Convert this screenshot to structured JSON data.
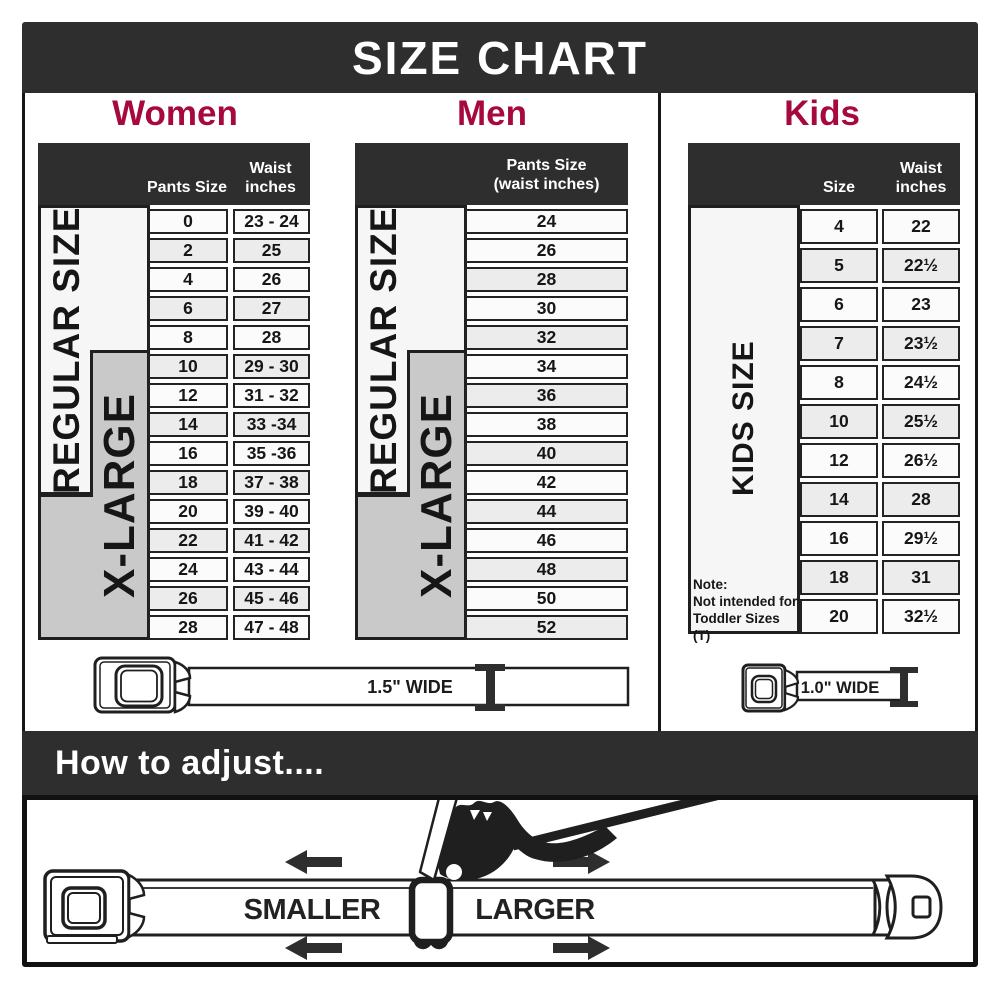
{
  "title": "SIZE CHART",
  "accent_color": "#A6093D",
  "bar_color": "#2e2e2e",
  "women": {
    "heading": "Women",
    "col1_header": "Pants Size",
    "col2_header_line1": "Waist",
    "col2_header_line2": "inches",
    "regular_label": "REGULAR SIZE",
    "xlarge_label": "X-LARGE",
    "rows": [
      {
        "size": "0",
        "waist": "23 - 24"
      },
      {
        "size": "2",
        "waist": "25"
      },
      {
        "size": "4",
        "waist": "26"
      },
      {
        "size": "6",
        "waist": "27"
      },
      {
        "size": "8",
        "waist": "28"
      },
      {
        "size": "10",
        "waist": "29 - 30"
      },
      {
        "size": "12",
        "waist": "31 - 32"
      },
      {
        "size": "14",
        "waist": "33 -34"
      },
      {
        "size": "16",
        "waist": "35 -36"
      },
      {
        "size": "18",
        "waist": "37 - 38"
      },
      {
        "size": "20",
        "waist": "39 - 40"
      },
      {
        "size": "22",
        "waist": "41 - 42"
      },
      {
        "size": "24",
        "waist": "43 - 44"
      },
      {
        "size": "26",
        "waist": "45 - 46"
      },
      {
        "size": "28",
        "waist": "47 - 48"
      }
    ]
  },
  "men": {
    "heading": "Men",
    "col_header_line1": "Pants Size",
    "col_header_line2": "(waist inches)",
    "regular_label": "REGULAR SIZE",
    "xlarge_label": "X-LARGE",
    "rows": [
      {
        "size": "24"
      },
      {
        "size": "26"
      },
      {
        "size": "28"
      },
      {
        "size": "30"
      },
      {
        "size": "32"
      },
      {
        "size": "34"
      },
      {
        "size": "36"
      },
      {
        "size": "38"
      },
      {
        "size": "40"
      },
      {
        "size": "42"
      },
      {
        "size": "44"
      },
      {
        "size": "46"
      },
      {
        "size": "48"
      },
      {
        "size": "50"
      },
      {
        "size": "52"
      }
    ]
  },
  "kids": {
    "heading": "Kids",
    "col1_header": "Size",
    "col2_header_line1": "Waist",
    "col2_header_line2": "inches",
    "side_label": "KIDS SIZE",
    "note_line1": "Note:",
    "note_line2": "Not intended for",
    "note_line3": "Toddler Sizes (T)",
    "rows": [
      {
        "size": "4",
        "waist": "22"
      },
      {
        "size": "5",
        "waist": "22½"
      },
      {
        "size": "6",
        "waist": "23"
      },
      {
        "size": "7",
        "waist": "23½"
      },
      {
        "size": "8",
        "waist": "24½"
      },
      {
        "size": "10",
        "waist": "25½"
      },
      {
        "size": "12",
        "waist": "26½"
      },
      {
        "size": "14",
        "waist": "28"
      },
      {
        "size": "16",
        "waist": "29½"
      },
      {
        "size": "18",
        "waist": "31"
      },
      {
        "size": "20",
        "waist": "32½"
      }
    ]
  },
  "belts": {
    "adult_width": "1.5\" WIDE",
    "kids_width": "1.0\" WIDE"
  },
  "adjust": {
    "heading": "How to adjust....",
    "smaller": "SMALLER",
    "larger": "LARGER"
  }
}
